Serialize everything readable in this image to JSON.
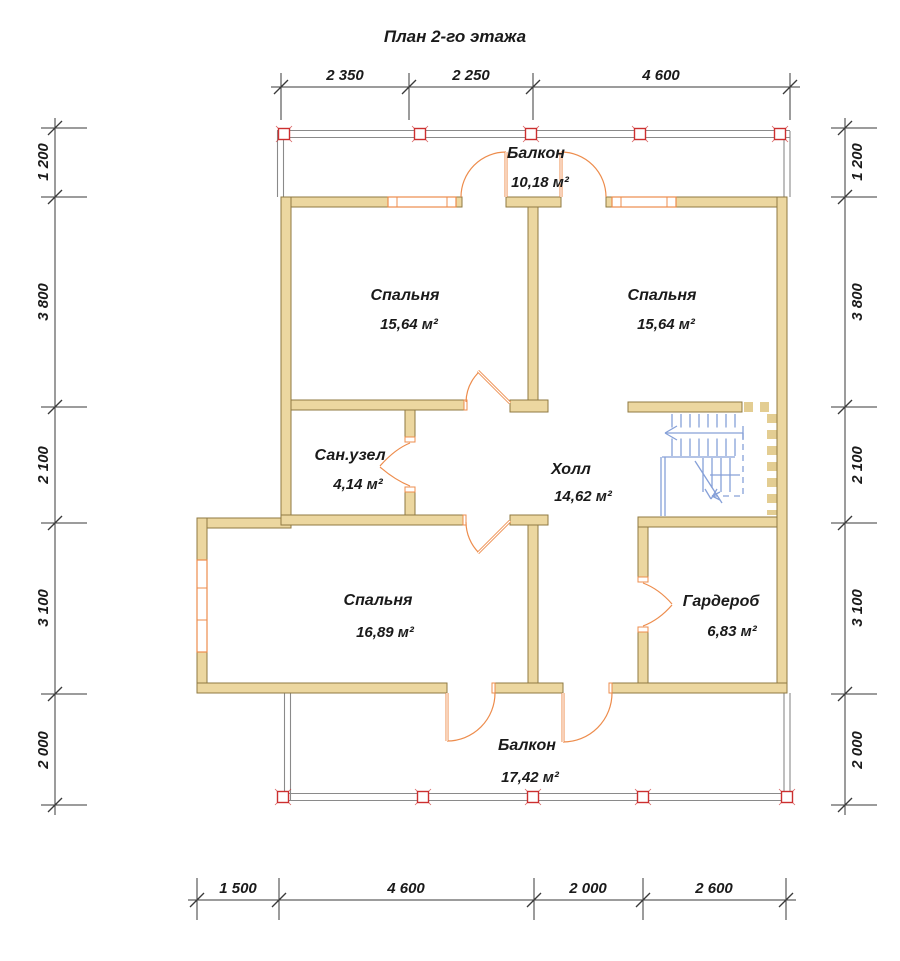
{
  "title": "План 2-го этажа",
  "rooms": {
    "bedroom_top_left": {
      "name": "Спальня",
      "area": "15,64 м²"
    },
    "bedroom_top_right": {
      "name": "Спальня",
      "area": "15,64 м²"
    },
    "bathroom": {
      "name": "Сан.узел",
      "area": "4,14 м²"
    },
    "hall": {
      "name": "Холл",
      "area": "14,62 м²"
    },
    "bedroom_bottom": {
      "name": "Спальня",
      "area": "16,89 м²"
    },
    "wardrobe": {
      "name": "Гардероб",
      "area": "6,83 м²"
    },
    "balcony_top": {
      "name": "Балкон",
      "area": "10,18 м²"
    },
    "balcony_bottom": {
      "name": "Балкон",
      "area": "17,42 м²"
    }
  },
  "dimensions": {
    "top": [
      "2 350",
      "2 250",
      "4 600"
    ],
    "bottom": [
      "1 500",
      "4 600",
      "2 000",
      "2 600"
    ],
    "left": [
      "1 200",
      "3 800",
      "2 100",
      "3 100",
      "2 000"
    ],
    "right": [
      "1 200",
      "3 800",
      "2 100",
      "3 100",
      "2 000"
    ]
  },
  "colors": {
    "wall_fill": "#ecd7a0",
    "wall_stroke": "#8f7a42",
    "joinery_orange": "#ed8c4c",
    "stair_blue": "#86a0d8",
    "railing_gray": "#8a8a8a",
    "post_red": "#cc2f2f",
    "dimension_line": "#3a3a3a",
    "text_black": "#1a1a1a",
    "hidden_dash_tan": "#e3cd92"
  }
}
